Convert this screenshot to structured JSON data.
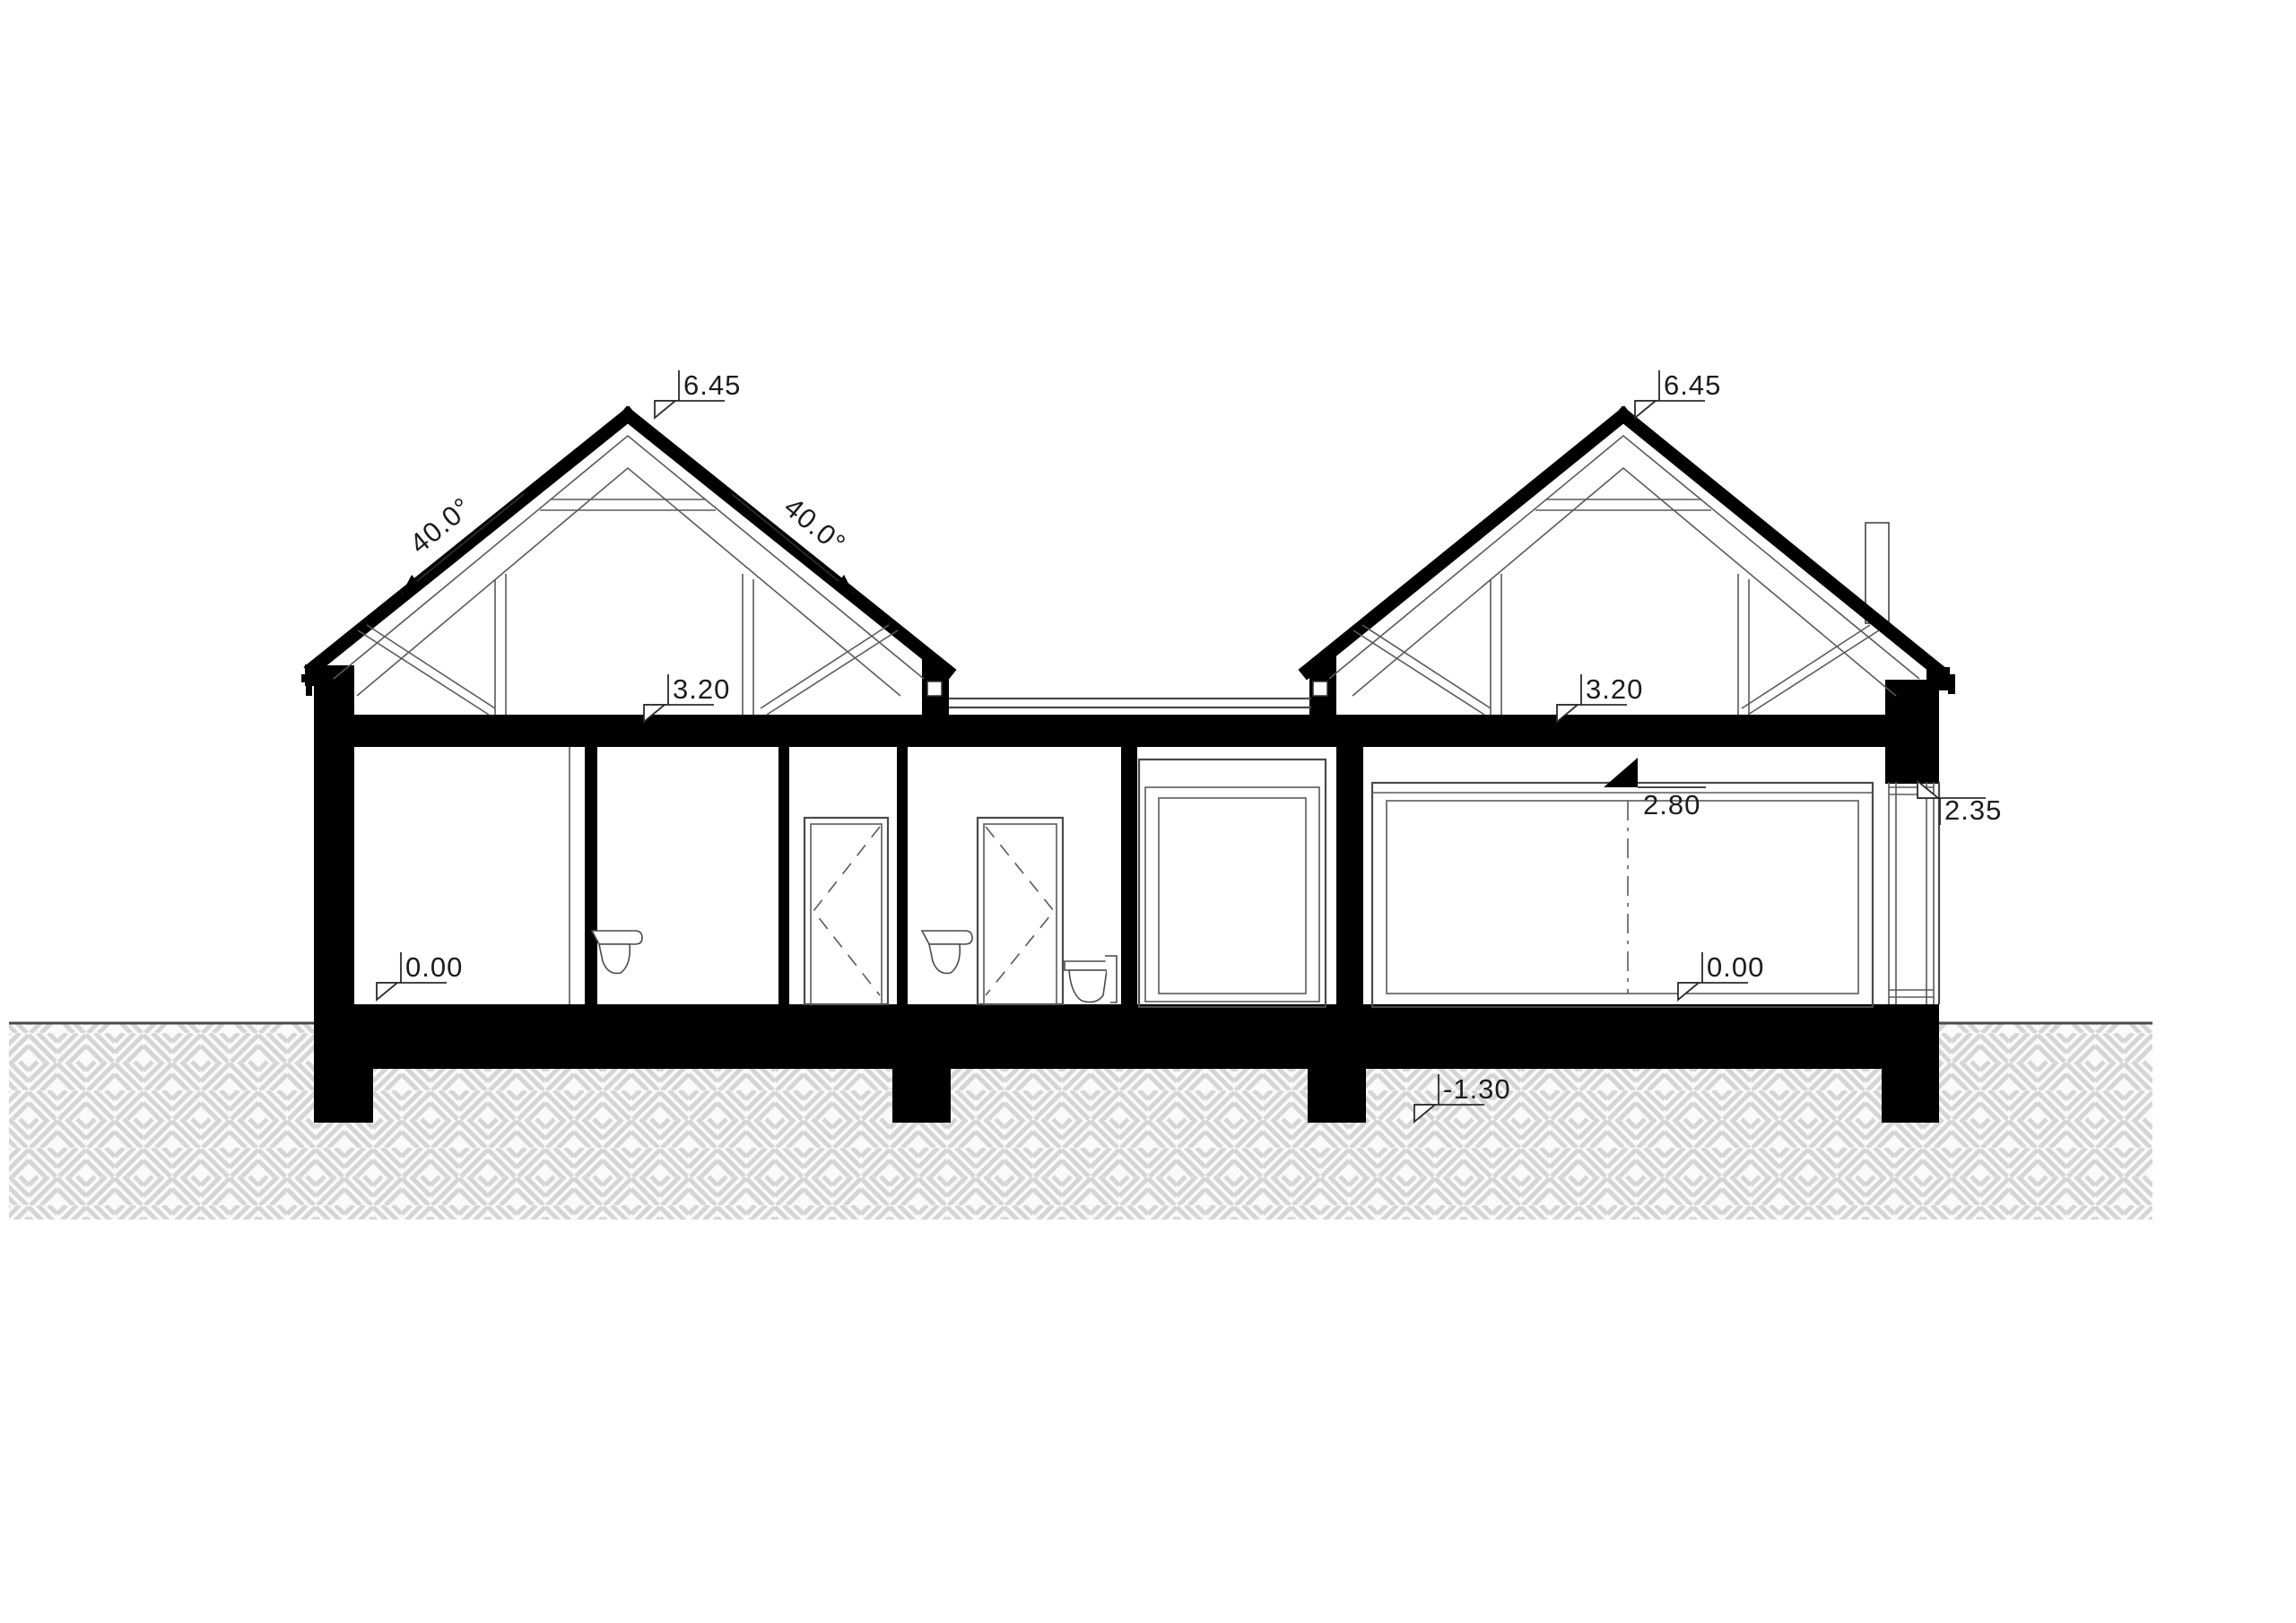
{
  "drawing": {
    "type": "architectural-cross-section",
    "annotations": {
      "left_peak_level": "6.45",
      "right_peak_level": "6.45",
      "left_slope_angle": "40.0°",
      "right_slope_angle": "40.0°",
      "left_ceiling_level": "3.20",
      "right_ceiling_level": "3.20",
      "left_floor_level": "0.00",
      "right_floor_level": "0.00",
      "lintel_level": "2.80",
      "window_head_level": "2.35",
      "foundation_level": "-1.30"
    },
    "colors": {
      "cut_elements": "#000000",
      "thin_lines": "#5a5a5a",
      "hatch_lines": "#d5d5d5",
      "background": "#ffffff"
    }
  }
}
